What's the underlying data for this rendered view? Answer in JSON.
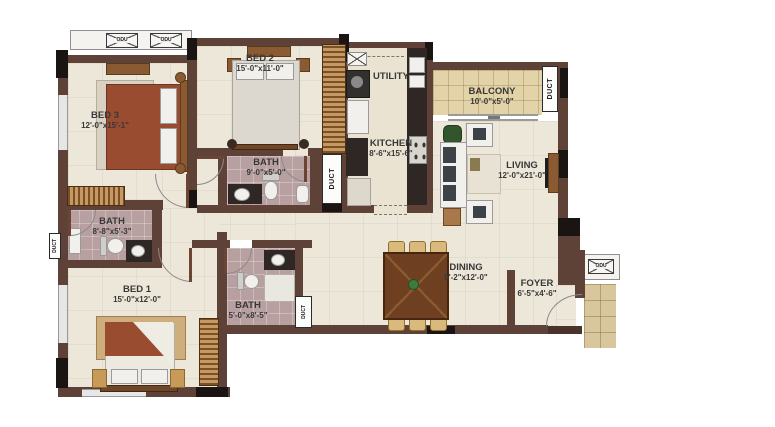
{
  "plan": {
    "rooms": {
      "bed3": {
        "label": "BED 3",
        "dims": "12'-0\"x15'-1\""
      },
      "bed2": {
        "label": "BED 2",
        "dims": "15'-0\"x11'-0\""
      },
      "bed1": {
        "label": "BED 1",
        "dims": "15'-0\"x12'-0\""
      },
      "bath_bed2": {
        "label": "BATH",
        "dims": "9'-0\"x5'-0\""
      },
      "bath_bed3": {
        "label": "BATH",
        "dims": "8'-8\"x5'-3\""
      },
      "bath_bed1": {
        "label": "BATH",
        "dims": "5'-0\"x8'-5\""
      },
      "utility": {
        "label": "UTILITY"
      },
      "kitchen": {
        "label": "KITCHEN",
        "dims": "8'-6\"x15'-6\""
      },
      "balcony": {
        "label": "BALCONY",
        "dims": "10'-0\"x5'-0\""
      },
      "living": {
        "label": "LIVING",
        "dims": "12'-0\"x21'-0\""
      },
      "dining": {
        "label": "DINING",
        "dims": "9'-2\"x12'-0\""
      },
      "foyer": {
        "label": "FOYER",
        "dims": "6'-5\"x4'-6\""
      }
    },
    "labels": {
      "duct": "DUCT",
      "odu": "ODU"
    },
    "colors": {
      "wall": "#5E4238",
      "floor": "#EDE7DA",
      "bath_floor": "#B9A0A0",
      "balcony_tile": "#E3D3A9",
      "wood": "#8A5A33",
      "counter": "#2E2724",
      "accent_black": "#1A1512",
      "bed_blanket": "#9A4C30"
    }
  }
}
